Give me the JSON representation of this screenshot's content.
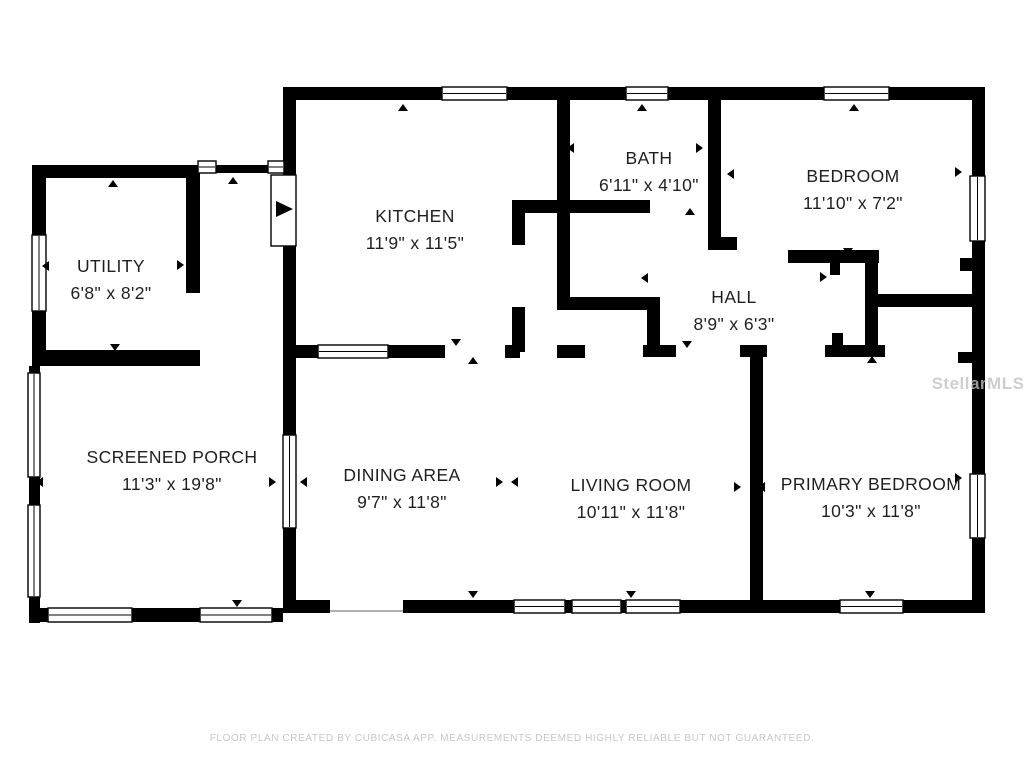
{
  "colors": {
    "wall": "#000000",
    "label": "#1f1f1f",
    "window_fill": "#ffffff",
    "threshold": "#b0b0b0",
    "watermark": "#c2c2c2",
    "footer_text": "#c7c7c7"
  },
  "footer": {
    "text": "FLOOR PLAN CREATED BY CUBICASA APP. MEASUREMENTS DEEMED HIGHLY RELIABLE BUT NOT GUARANTEED."
  },
  "watermark": {
    "text": "StellarMLS",
    "x": 978,
    "y": 374
  },
  "floorplan": {
    "rooms": [
      {
        "name": "UTILITY",
        "dims": "6'8\" x 8'2\"",
        "cx": 111,
        "y": 272
      },
      {
        "name": "KITCHEN",
        "dims": "11'9\" x 11'5\"",
        "cx": 415,
        "y": 222
      },
      {
        "name": "BATH",
        "dims": "6'11\" x 4'10\"",
        "cx": 649,
        "y": 164
      },
      {
        "name": "BEDROOM",
        "dims": "11'10\" x 7'2\"",
        "cx": 853,
        "y": 182
      },
      {
        "name": "HALL",
        "dims": "8'9\" x 6'3\"",
        "cx": 734,
        "y": 303
      },
      {
        "name": "SCREENED PORCH",
        "dims": "11'3\" x 19'8\"",
        "cx": 172,
        "y": 463
      },
      {
        "name": "DINING AREA",
        "dims": "9'7\" x 11'8\"",
        "cx": 402,
        "y": 481
      },
      {
        "name": "LIVING ROOM",
        "dims": "10'11\" x 11'8\"",
        "cx": 631,
        "y": 491
      },
      {
        "name": "PRIMARY BEDROOM",
        "dims": "10'3\" x 11'8\"",
        "cx": 871,
        "y": 490
      }
    ],
    "walls": [
      [
        283,
        87,
        702,
        13
      ],
      [
        972,
        87,
        13,
        526
      ],
      [
        283,
        600,
        47,
        13
      ],
      [
        403,
        600,
        582,
        13
      ],
      [
        283,
        87,
        13,
        88
      ],
      [
        283,
        246,
        13,
        189
      ],
      [
        283,
        528,
        13,
        85
      ],
      [
        32,
        165,
        168,
        13
      ],
      [
        32,
        165,
        14,
        70
      ],
      [
        32,
        311,
        14,
        55
      ],
      [
        186,
        165,
        14,
        128
      ],
      [
        32,
        350,
        168,
        16
      ],
      [
        200,
        165,
        83,
        8
      ],
      [
        29,
        366,
        11,
        8
      ],
      [
        29,
        477,
        11,
        28
      ],
      [
        29,
        597,
        11,
        26
      ],
      [
        29,
        608,
        19,
        14
      ],
      [
        132,
        608,
        68,
        14
      ],
      [
        272,
        608,
        11,
        14
      ],
      [
        557,
        100,
        13,
        103
      ],
      [
        512,
        200,
        138,
        13
      ],
      [
        708,
        100,
        13,
        150
      ],
      [
        708,
        237,
        29,
        13
      ],
      [
        512,
        203,
        13,
        42
      ],
      [
        512,
        307,
        13,
        45
      ],
      [
        557,
        203,
        13,
        97
      ],
      [
        557,
        297,
        103,
        13
      ],
      [
        647,
        297,
        13,
        55
      ],
      [
        283,
        345,
        162,
        13
      ],
      [
        505,
        345,
        15,
        13
      ],
      [
        557,
        345,
        28,
        13
      ],
      [
        643,
        345,
        33,
        12
      ],
      [
        740,
        345,
        27,
        12
      ],
      [
        825,
        345,
        60,
        12
      ],
      [
        832,
        333,
        11,
        12
      ],
      [
        958,
        352,
        14,
        11
      ],
      [
        750,
        345,
        13,
        255
      ],
      [
        788,
        250,
        91,
        13
      ],
      [
        830,
        263,
        10,
        12
      ],
      [
        865,
        250,
        13,
        97
      ],
      [
        878,
        294,
        94,
        13
      ],
      [
        960,
        258,
        12,
        13
      ]
    ],
    "windows": [
      [
        442,
        87,
        65,
        13
      ],
      [
        626,
        87,
        42,
        13
      ],
      [
        824,
        87,
        65,
        13
      ],
      [
        970,
        176,
        15,
        65
      ],
      [
        970,
        474,
        15,
        64
      ],
      [
        514,
        600,
        51,
        13
      ],
      [
        572,
        600,
        49,
        13
      ],
      [
        626,
        600,
        54,
        13
      ],
      [
        840,
        600,
        63,
        13
      ],
      [
        318,
        345,
        70,
        13
      ],
      [
        283,
        435,
        13,
        93
      ],
      [
        32,
        235,
        14,
        76
      ],
      [
        28,
        373,
        12,
        104
      ],
      [
        28,
        505,
        12,
        92
      ],
      [
        48,
        608,
        84,
        14
      ],
      [
        200,
        608,
        72,
        14
      ],
      [
        198,
        161,
        18,
        12
      ],
      [
        268,
        161,
        16,
        12
      ]
    ],
    "door": {
      "leaf": [
        271,
        175,
        25,
        71
      ],
      "arrow": "276,201 293,209 276,217"
    },
    "threshold": [
      330,
      610,
      73,
      2
    ],
    "markers": [
      {
        "d": "up",
        "x": 403,
        "y": 104
      },
      {
        "d": "up",
        "x": 642,
        "y": 104
      },
      {
        "d": "up",
        "x": 854,
        "y": 104
      },
      {
        "d": "up",
        "x": 233,
        "y": 177
      },
      {
        "d": "up",
        "x": 113,
        "y": 180
      },
      {
        "d": "up",
        "x": 473,
        "y": 357
      },
      {
        "d": "up",
        "x": 690,
        "y": 208
      },
      {
        "d": "up",
        "x": 872,
        "y": 356
      },
      {
        "d": "down",
        "x": 473,
        "y": 591
      },
      {
        "d": "down",
        "x": 631,
        "y": 591
      },
      {
        "d": "down",
        "x": 870,
        "y": 591
      },
      {
        "d": "down",
        "x": 237,
        "y": 600
      },
      {
        "d": "down",
        "x": 115,
        "y": 344
      },
      {
        "d": "down",
        "x": 456,
        "y": 339
      },
      {
        "d": "down",
        "x": 848,
        "y": 248
      },
      {
        "d": "down",
        "x": 687,
        "y": 341
      },
      {
        "d": "left",
        "x": 567,
        "y": 148
      },
      {
        "d": "left",
        "x": 727,
        "y": 174
      },
      {
        "d": "left",
        "x": 641,
        "y": 278
      },
      {
        "d": "left",
        "x": 36,
        "y": 482
      },
      {
        "d": "left",
        "x": 758,
        "y": 487
      },
      {
        "d": "left",
        "x": 511,
        "y": 482
      },
      {
        "d": "left",
        "x": 300,
        "y": 482
      },
      {
        "d": "left",
        "x": 42,
        "y": 266
      },
      {
        "d": "right",
        "x": 703,
        "y": 148
      },
      {
        "d": "right",
        "x": 962,
        "y": 172
      },
      {
        "d": "right",
        "x": 827,
        "y": 277
      },
      {
        "d": "right",
        "x": 962,
        "y": 478
      },
      {
        "d": "right",
        "x": 276,
        "y": 482
      },
      {
        "d": "right",
        "x": 741,
        "y": 487
      },
      {
        "d": "right",
        "x": 503,
        "y": 482
      },
      {
        "d": "right",
        "x": 184,
        "y": 265
      }
    ]
  }
}
